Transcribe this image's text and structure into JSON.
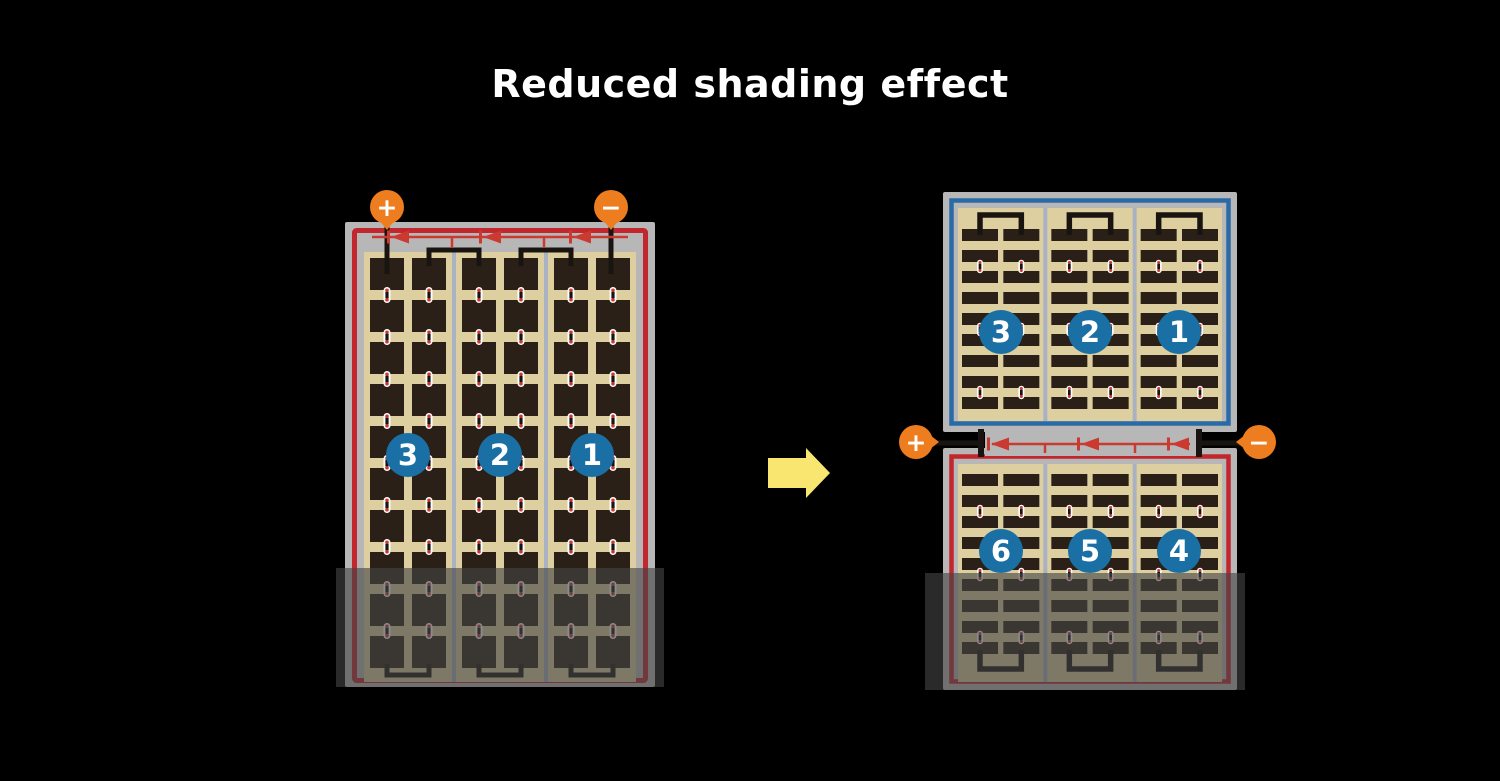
{
  "title": "Reduced shading effect",
  "colors": {
    "background": "#000000",
    "title_text": "#ffffff",
    "terminal_orange": "#ee7d1f",
    "frame_gray": "#b7b7b7",
    "string_red": "#c1272d",
    "string_blue": "#2a6ba6",
    "diode_red": "#cb3a31",
    "cell_bg_tan": "#ddcfa0",
    "cell_dark": "#2a2017",
    "divider_gray": "#a8b2c2",
    "circle_blue": "#1a6fa4",
    "arrow_yellow": "#f8e671",
    "wire_black": "#1a1410",
    "shade": "rgba(68,68,68,0.62)"
  },
  "left_panel": {
    "positive_label": "+",
    "negative_label": "−",
    "string_labels": [
      "3",
      "2",
      "1"
    ]
  },
  "right_panel": {
    "positive_label": "+",
    "negative_label": "−",
    "top_string_labels": [
      "3",
      "2",
      "1"
    ],
    "bottom_string_labels": [
      "6",
      "5",
      "4"
    ]
  }
}
